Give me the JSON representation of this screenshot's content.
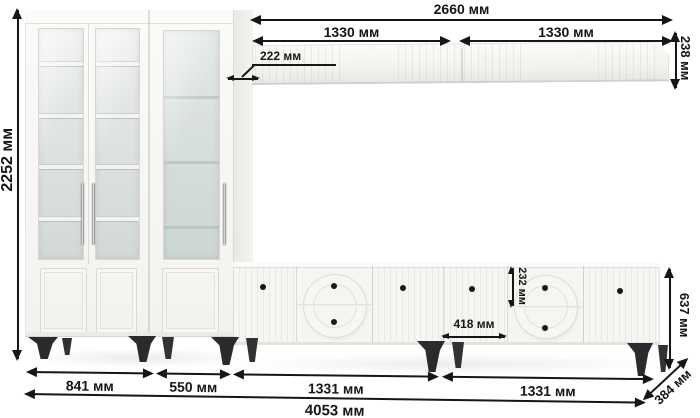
{
  "meta": {
    "units": "мм",
    "language": "ru",
    "subject": "wall-unit furniture dimension drawing"
  },
  "dims": {
    "height_total": "2252 мм",
    "shelf_width_total": "2660 мм",
    "shelf_width_left": "1330 мм",
    "shelf_width_right": "1330 мм",
    "shelf_height": "238 мм",
    "shelf_depth": "222 мм",
    "tv_drawer_height": "232 мм",
    "tv_door_width": "418 мм",
    "tv_height": "637 мм",
    "tv_depth": "384 мм",
    "width_glass_cabinet": "841 мм",
    "width_display_cabinet": "550 мм",
    "width_tv_left": "1331 мм",
    "width_tv_right": "1331 мм",
    "width_total": "4053 мм"
  },
  "colors": {
    "dimension_ink": "#161616",
    "furniture_body": "#f6f5f2",
    "glass_tint": "#dce3e1",
    "legs": "#2b2b2e",
    "background": "#ffffff"
  }
}
